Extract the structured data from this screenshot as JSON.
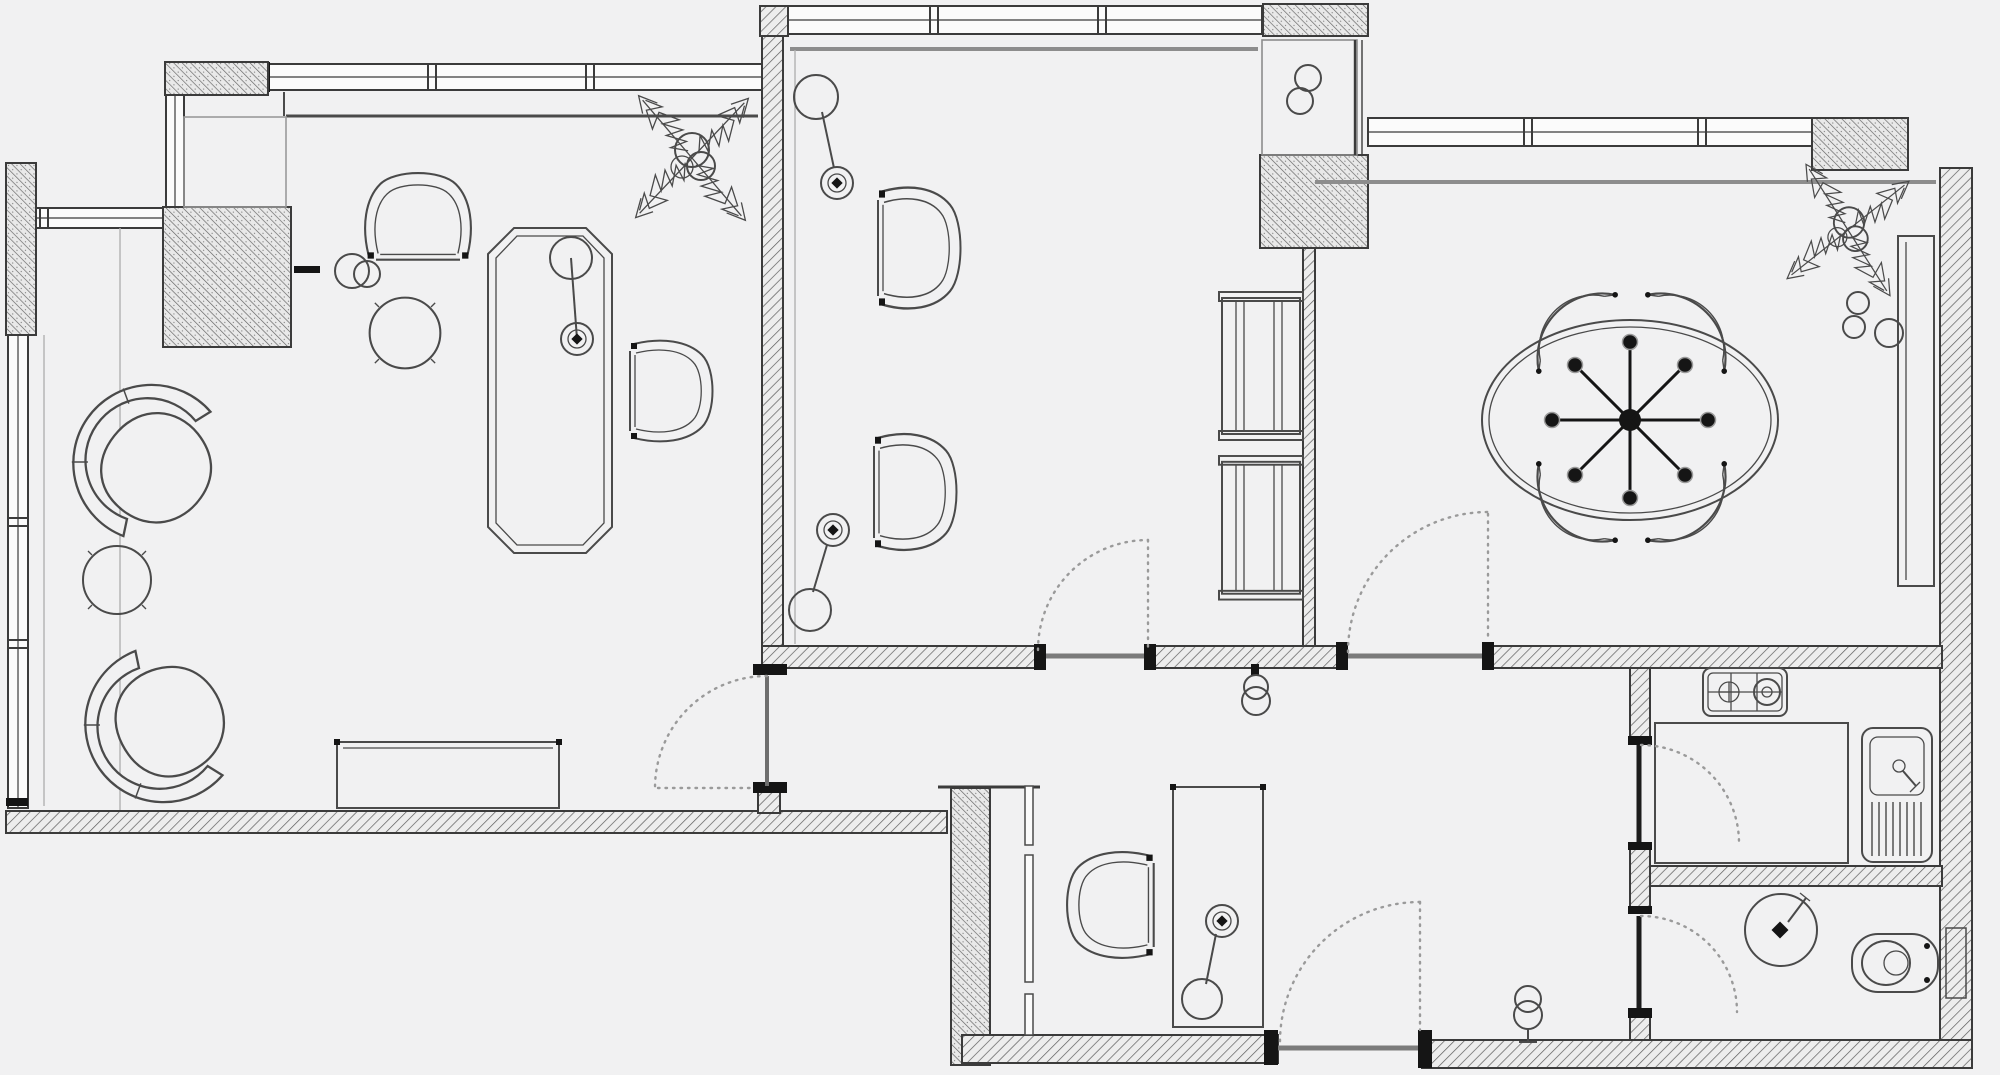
{
  "drawing": {
    "kind": "architectural-floor-plan",
    "visible_text": "",
    "canvas": {
      "width": 2000,
      "height": 1075,
      "background_color": "#f1f1f2",
      "primary_line_color": "#3b3b3b",
      "secondary_line_color": "#8d8d8d",
      "wall_hatch_color": "#5c5c5c",
      "door_swing_style": "dotted-arc"
    },
    "regions": [
      {
        "id": "lounge",
        "name": "lounge-area",
        "symbols": [
          "organic-armchair",
          "organic-armchair",
          "round-side-table",
          "round-side-table",
          "round-back-chair",
          "side-chair",
          "octagonal-long-table",
          "table-lamp",
          "sideboard",
          "wall-knob"
        ]
      },
      {
        "id": "study",
        "name": "study-room",
        "symbols": [
          "side-chair",
          "side-chair",
          "floor-lamp",
          "floor-lamp",
          "shelf-unit",
          "shelf-unit",
          "closet-niche-with-knobs"
        ]
      },
      {
        "id": "dining",
        "name": "dining-room",
        "symbols": [
          "oval-table",
          "eight-arm-chandelier",
          "shell-chair",
          "shell-chair",
          "shell-chair",
          "shell-chair",
          "wall-counter",
          "bowl",
          "bowl",
          "bowl",
          "potted-plant"
        ]
      },
      {
        "id": "kitchen",
        "name": "kitchen",
        "symbols": [
          "two-burner-cooktop",
          "counter-block",
          "sink-with-drainboard"
        ]
      },
      {
        "id": "bathroom",
        "name": "bathroom",
        "symbols": [
          "round-washbasin",
          "toilet",
          "wall-radiator"
        ]
      },
      {
        "id": "deskroom",
        "name": "desk-room",
        "symbols": [
          "desk",
          "desk-chair",
          "floor-lamp"
        ]
      },
      {
        "id": "hall",
        "name": "hallway",
        "symbols": [
          "wall-hook",
          "wall-hook"
        ]
      }
    ],
    "openings": {
      "door_count": 6,
      "window_band_count": 6,
      "doors": [
        "lounge-hall-door",
        "study-hall-door",
        "dining-hall-door",
        "kitchen-door",
        "bathroom-door",
        "deskroom-door"
      ],
      "windows": [
        "lounge-top-window",
        "lounge-left-window",
        "lounge-corner-window-vertical",
        "lounge-corner-window-horizontal",
        "study-top-window",
        "dining-top-window"
      ]
    },
    "plant_count": 2
  }
}
